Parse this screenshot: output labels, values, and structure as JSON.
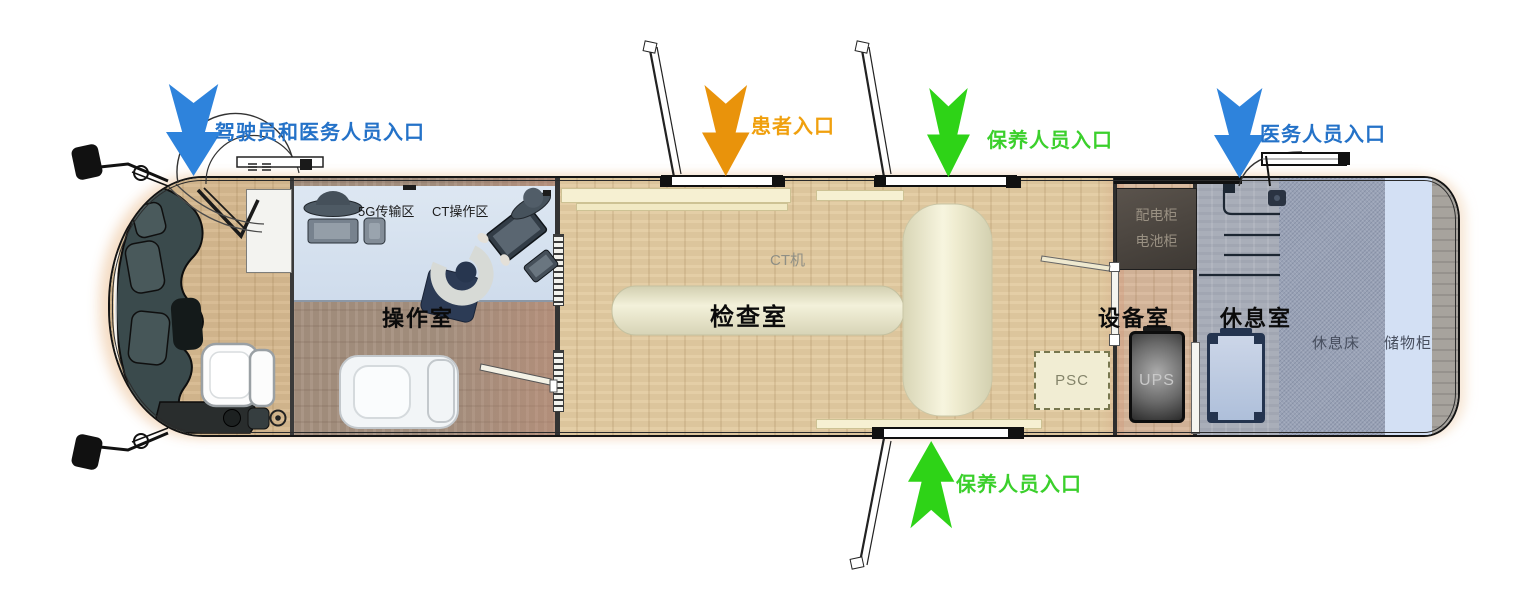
{
  "entrances": {
    "driver_and_medical": {
      "label": "驾驶员和医务人员入口",
      "color": "#2e83dc"
    },
    "patient": {
      "label": "患者入口",
      "color": "#e9930b"
    },
    "maintenance_top": {
      "label": "保养人员入口",
      "color": "#2ed317"
    },
    "medical": {
      "label": "医务人员入口",
      "color": "#2e83dc"
    },
    "maintenance_bottom": {
      "label": "保养人员入口",
      "color": "#2ed317"
    }
  },
  "rooms": {
    "operation": {
      "name": "操作室",
      "zones": {
        "transmission_5g": "5G传输区",
        "ct_operation": "CT操作区"
      }
    },
    "examination": {
      "name": "检查室",
      "equipment": {
        "ct_machine": "CT机",
        "psc": "PSC"
      }
    },
    "equipment": {
      "name": "设备室",
      "cabinets": {
        "power_distribution": "配电柜",
        "battery": "电池柜",
        "ups": "UPS"
      }
    },
    "rest": {
      "name": "休息室",
      "furniture": {
        "bed": "休息床",
        "storage": "储物柜"
      }
    }
  }
}
